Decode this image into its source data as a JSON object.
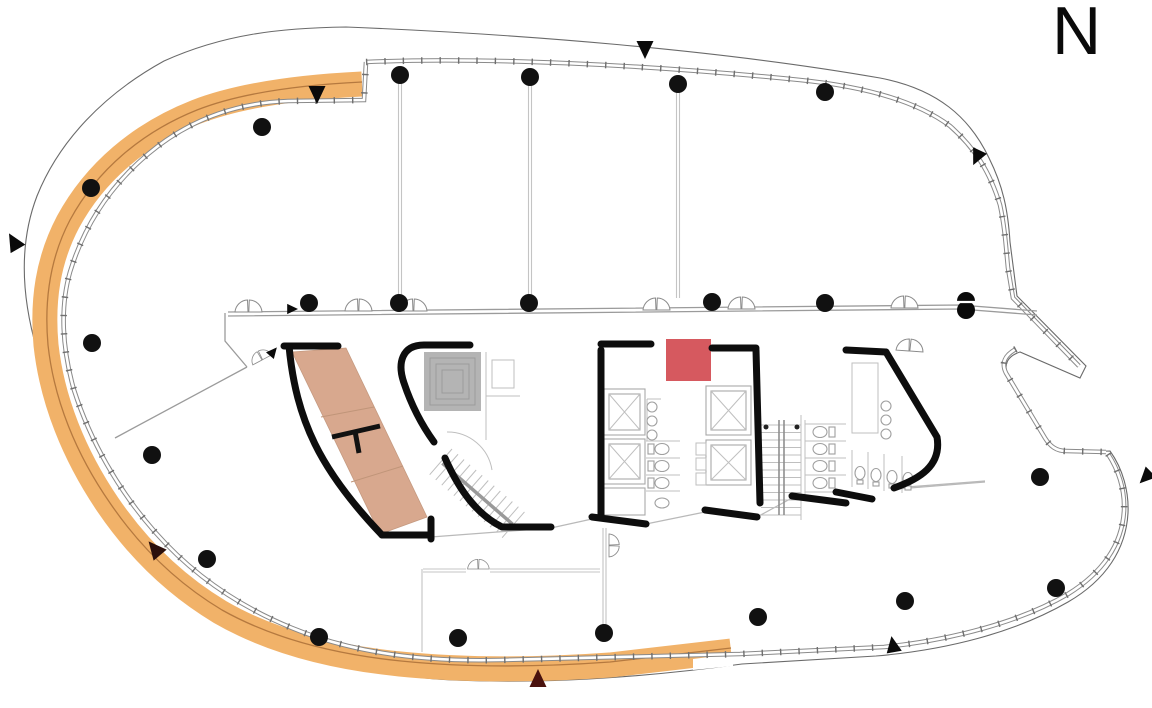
{
  "compass": {
    "label": "N"
  },
  "colors": {
    "band": "#f1b269",
    "band_line": "#b5793f",
    "tan_room": "#d8a88e",
    "tan_room_edge": "#c59a80",
    "gray_room": "#b4b4b4",
    "red_room": "#d6595f",
    "wall": "#0d0d0d",
    "column": "#111111",
    "marker_black": "#0a0a0a",
    "marker_maroon": "#4a120e"
  },
  "structure": {
    "columns": [
      [
        400,
        75
      ],
      [
        530,
        77
      ],
      [
        678,
        84
      ],
      [
        825,
        92
      ],
      [
        262,
        127
      ],
      [
        91,
        188
      ],
      [
        92,
        343
      ],
      [
        152,
        455
      ],
      [
        309,
        303
      ],
      [
        399,
        303
      ],
      [
        529,
        303
      ],
      [
        712,
        302
      ],
      [
        825,
        303
      ],
      [
        207,
        559
      ],
      [
        319,
        637
      ],
      [
        458,
        638
      ],
      [
        604,
        633
      ],
      [
        758,
        617
      ],
      [
        905,
        601
      ],
      [
        1056,
        588
      ],
      [
        1040,
        477
      ]
    ],
    "column_radius": 9,
    "section_marker": {
      "x": 966,
      "y": 310
    },
    "markers": [
      {
        "x": 317,
        "y": 94,
        "rot": 180,
        "color": "#0a0a0a",
        "s": 1
      },
      {
        "x": 645,
        "y": 49,
        "rot": 180,
        "color": "#0a0a0a",
        "s": 1
      },
      {
        "x": 977,
        "y": 157,
        "rot": 205,
        "color": "#0a0a0a",
        "s": 0.9
      },
      {
        "x": 14,
        "y": 242,
        "rot": -30,
        "color": "#0a0a0a",
        "s": 1
      },
      {
        "x": 155,
        "y": 549,
        "rot": -40,
        "color": "#2b0f0c",
        "s": 1
      },
      {
        "x": 538,
        "y": 679,
        "rot": 0,
        "color": "#4a120e",
        "s": 1
      },
      {
        "x": 893,
        "y": 645,
        "rot": -10,
        "color": "#0a0a0a",
        "s": 0.9
      },
      {
        "x": 1146,
        "y": 477,
        "rot": 225,
        "color": "#0a0a0a",
        "s": 0.9
      },
      {
        "x": 292,
        "y": 309,
        "rot": 90,
        "color": "#0a0a0a",
        "s": 0.6
      },
      {
        "x": 273,
        "y": 352,
        "rot": 40,
        "color": "#0a0a0a",
        "s": 0.6
      }
    ]
  }
}
